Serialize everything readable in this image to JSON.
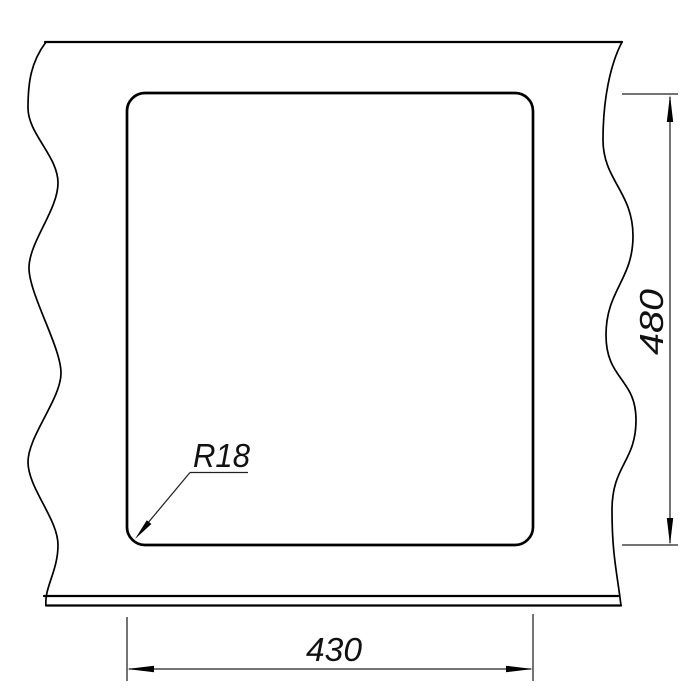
{
  "dimensions": {
    "height": {
      "label": "480"
    },
    "width": {
      "label": "430"
    },
    "radius": {
      "label": "R18"
    }
  }
}
